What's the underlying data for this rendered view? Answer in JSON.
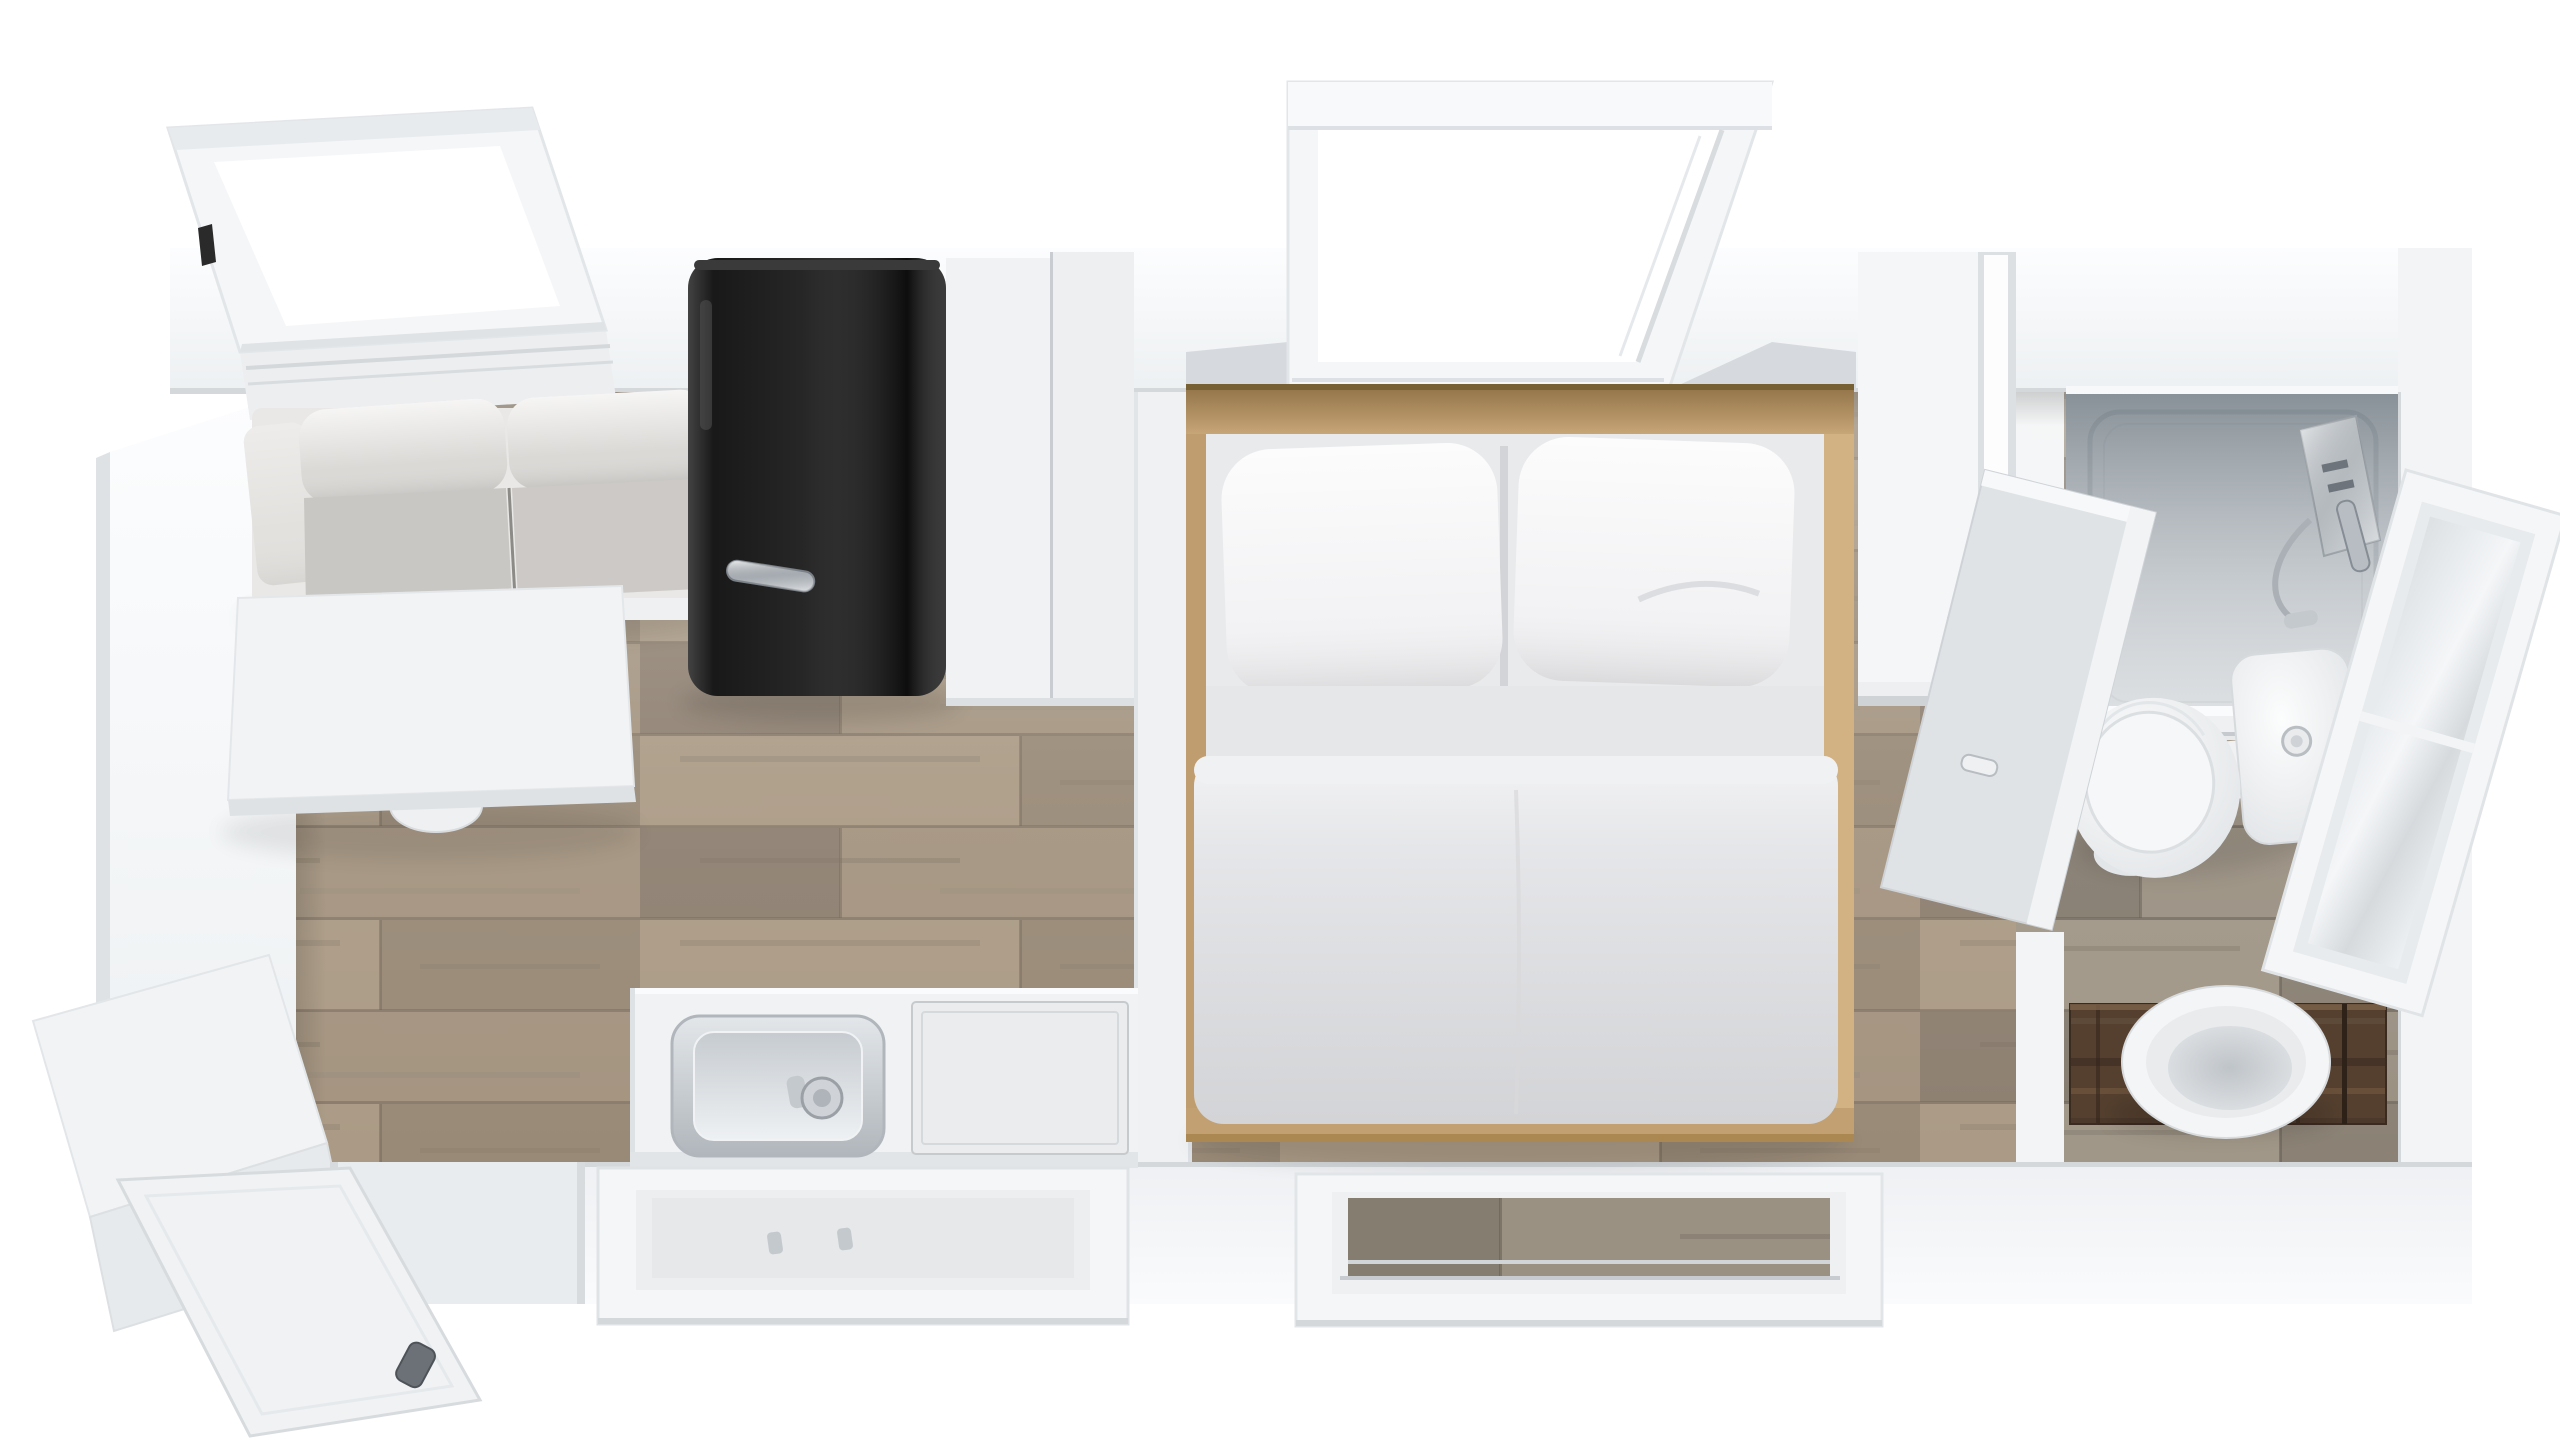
{
  "scene": {
    "kind": "3d-floor-plan-render",
    "view": "top-down",
    "canvas": {
      "width": 2560,
      "height": 1440
    },
    "rooms": [
      {
        "name": "living-kitchen",
        "floor": "light-oak-planks"
      },
      {
        "name": "bedroom",
        "floor": "light-oak-planks"
      },
      {
        "name": "bathroom",
        "floor": "gray-oak-planks"
      }
    ],
    "elements": [
      "roof-window-left",
      "sofa",
      "pedestal-table",
      "refrigerator",
      "tall-cabinets",
      "divider-panel",
      "kitchen-counter",
      "kitchen-sink",
      "cooktop-panel",
      "kitchen-window",
      "entry-door",
      "entry-porch",
      "double-bed",
      "pillows",
      "duvet",
      "roof-window-bedroom",
      "bedroom-window",
      "wardrobe",
      "partition-wall",
      "bathroom-door",
      "shower-enclosure",
      "shower-fixture",
      "toilet",
      "vanity-counter",
      "vessel-sink",
      "bathroom-window"
    ]
  },
  "palette": {
    "background": "#ffffff",
    "wall": "#f4f5f7",
    "wall_bright": "#fbfcfd",
    "wall_shadow": "#dfe2e5",
    "wall_edge": "#cfd3d7",
    "floor_wood": "#a2927f",
    "floor_wood_light": "#ab9b86",
    "floor_wood_dark": "#8e8071",
    "bath_floor": "#948a7e",
    "sofa_fabric": "#dbd9d6",
    "sofa_seat": "#c9c7c4",
    "table_top": "#f2f3f4",
    "fridge_body": "#141414",
    "chrome": "#c4c9ce",
    "cabinet": "#edeff1",
    "cabinet_shade": "#dde0e3",
    "bed_wood": "#c7a577",
    "bed_wood_dark": "#ab8752",
    "mattress": "#e9eaec",
    "pillow": "#f3f3f5",
    "duvet": "#e3e4e7",
    "porcelain": "#f4f5f6",
    "porcelain_shade": "#d7dadd",
    "glass_tint": "#6f7a83",
    "shower_tray": "#e7e9eb",
    "vanity_wood": "#55402f",
    "window_frame": "#f5f6f8",
    "frame_shade": "#d4d8db"
  }
}
